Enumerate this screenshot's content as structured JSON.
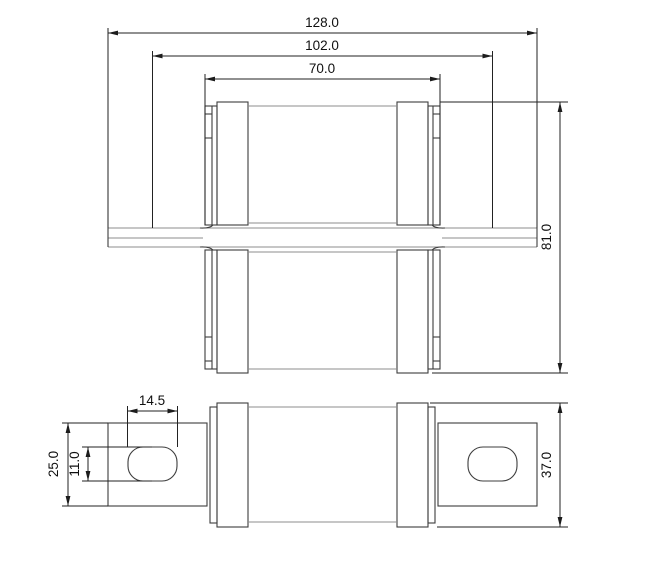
{
  "drawing": {
    "type": "technical-dimension-drawing",
    "part": "bolt-on fuse, two orthographic views",
    "colors": {
      "background": "#ffffff",
      "outline": "#3d3d3d",
      "thin_edge": "#8c8c8c",
      "dimension": "#1c1c1c"
    },
    "dimensions": {
      "overall_width": "128.0",
      "hole_spacing": "102.0",
      "body_width": "70.0",
      "overall_height": "81.0",
      "slot_length": "14.5",
      "terminal_width": "25.0",
      "slot_width": "11.0",
      "cap_diameter": "37.0"
    }
  }
}
